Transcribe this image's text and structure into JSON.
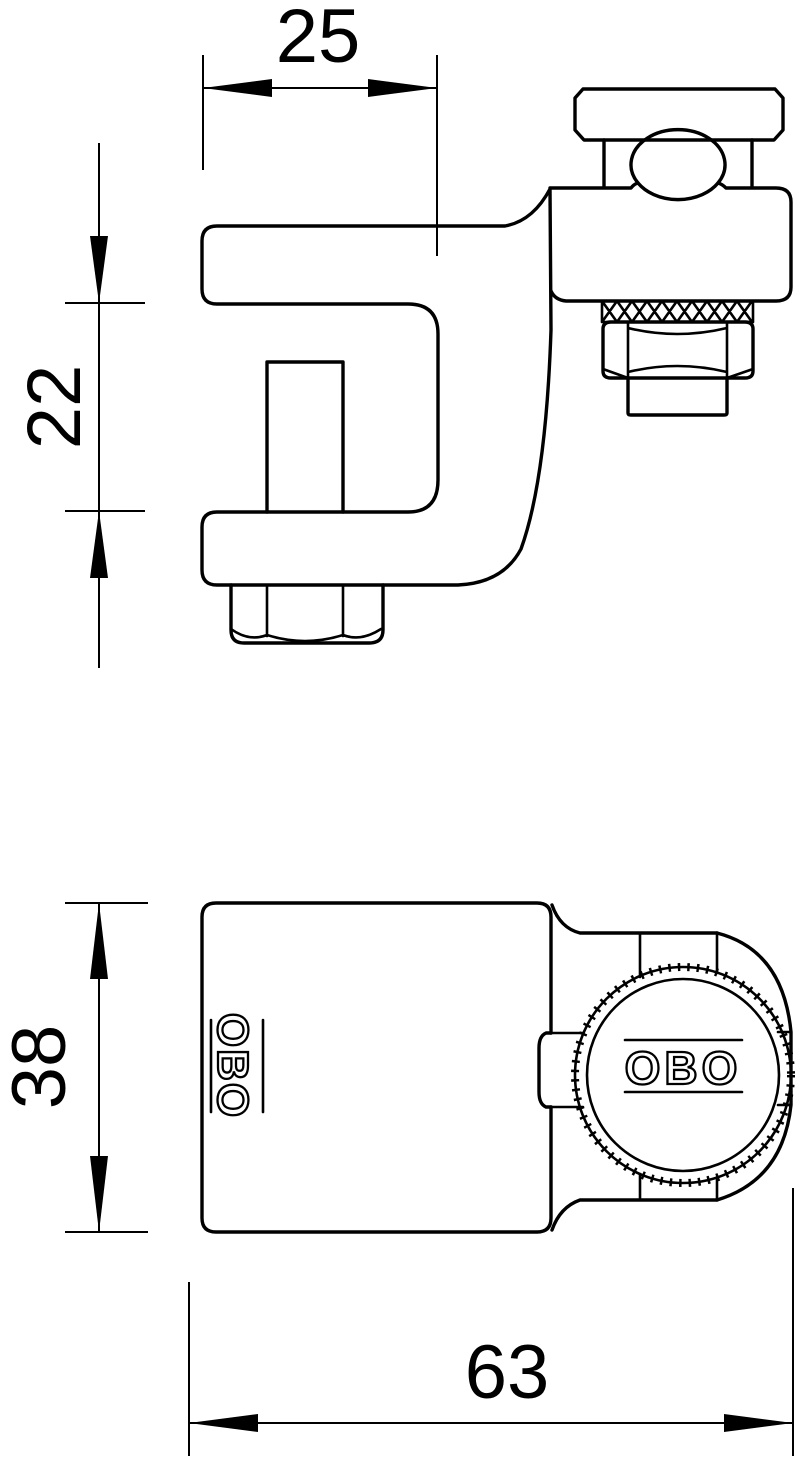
{
  "drawing": {
    "logo": "OBO",
    "dimensions": {
      "jaw_depth": "25",
      "jaw_opening": "22",
      "body_height": "38",
      "total_width": "63"
    },
    "colors": {
      "line": "#000000",
      "background": "#ffffff"
    }
  }
}
